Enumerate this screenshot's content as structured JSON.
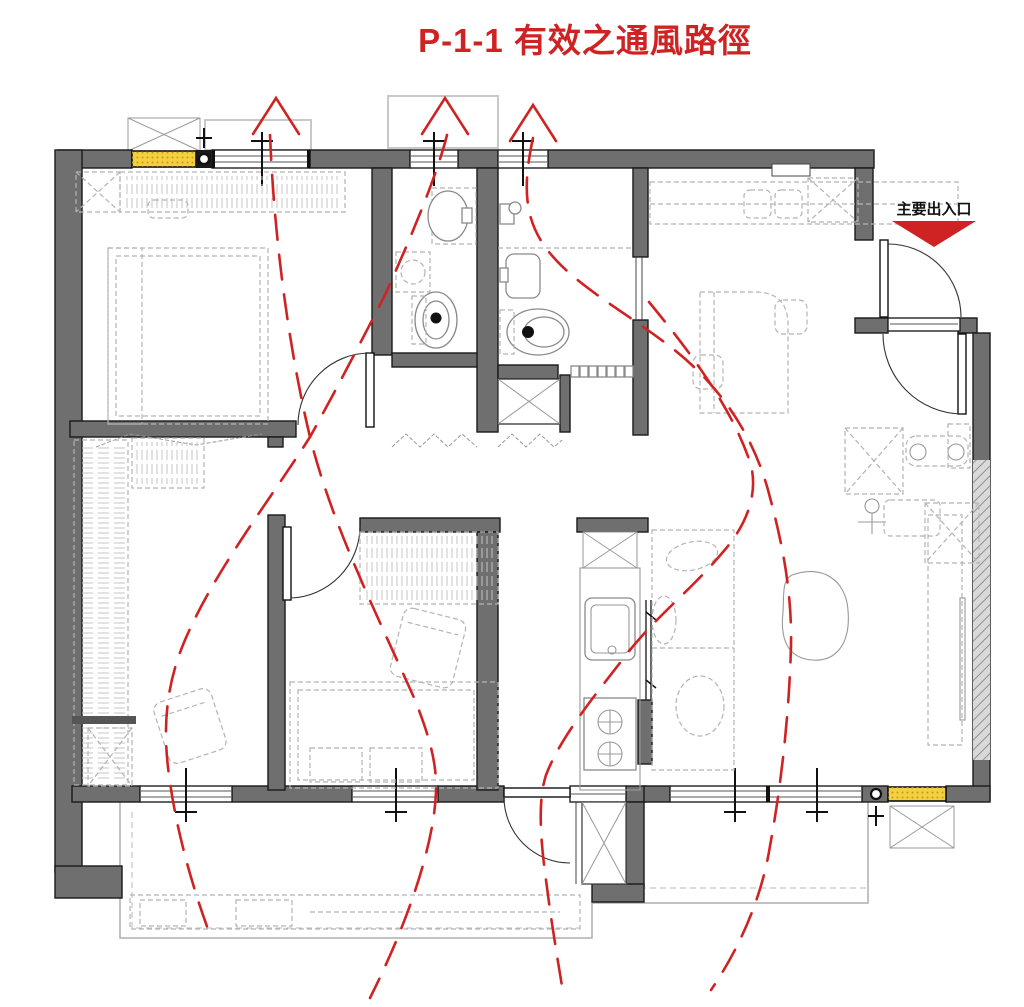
{
  "title": {
    "text": "P-1-1 有效之通風路徑"
  },
  "entrance": {
    "label": "主要出入口"
  },
  "colors": {
    "accent_red": "#cf2323",
    "wall_gray": "#6f6f6f",
    "sill_yellow": "#f4d03f",
    "furniture_gray": "#b4b4b4",
    "fixture_gray": "#8a8a8a",
    "balcony_gray": "#aeaeae"
  },
  "ventilation": {
    "arrows": [
      {
        "x": 276,
        "y": 98
      },
      {
        "x": 445,
        "y": 98
      },
      {
        "x": 533,
        "y": 105
      }
    ],
    "arrow_leg_dx": 23,
    "arrow_leg_dy": 36,
    "paths": [
      "M 270 135 C 274 235 288 345 310 437 C 332 525 375 610 415 700 C 430 738 437 764 436 792 C 434 845 408 922 370 998",
      "M 447 135 C 437 175 412 235 385 295 C 362 340 336 390 310 437 C 270 500 215 570 185 640 C 167 682 162 725 169 775 C 176 830 193 890 212 940",
      "M 533 138 C 524 180 522 216 546 248 C 572 284 626 312 672 348 C 718 384 752 432 768 490 C 783 545 792 592 791 646 C 789 720 780 792 770 846 C 762 896 741 946 711 990",
      "M 649 302 C 690 352 731 406 750 462 C 758 488 751 520 723 552 C 692 589 660 613 630 650 C 596 694 561 736 546 775 C 538 800 540 836 546 880 C 551 920 557 956 563 992"
    ]
  }
}
